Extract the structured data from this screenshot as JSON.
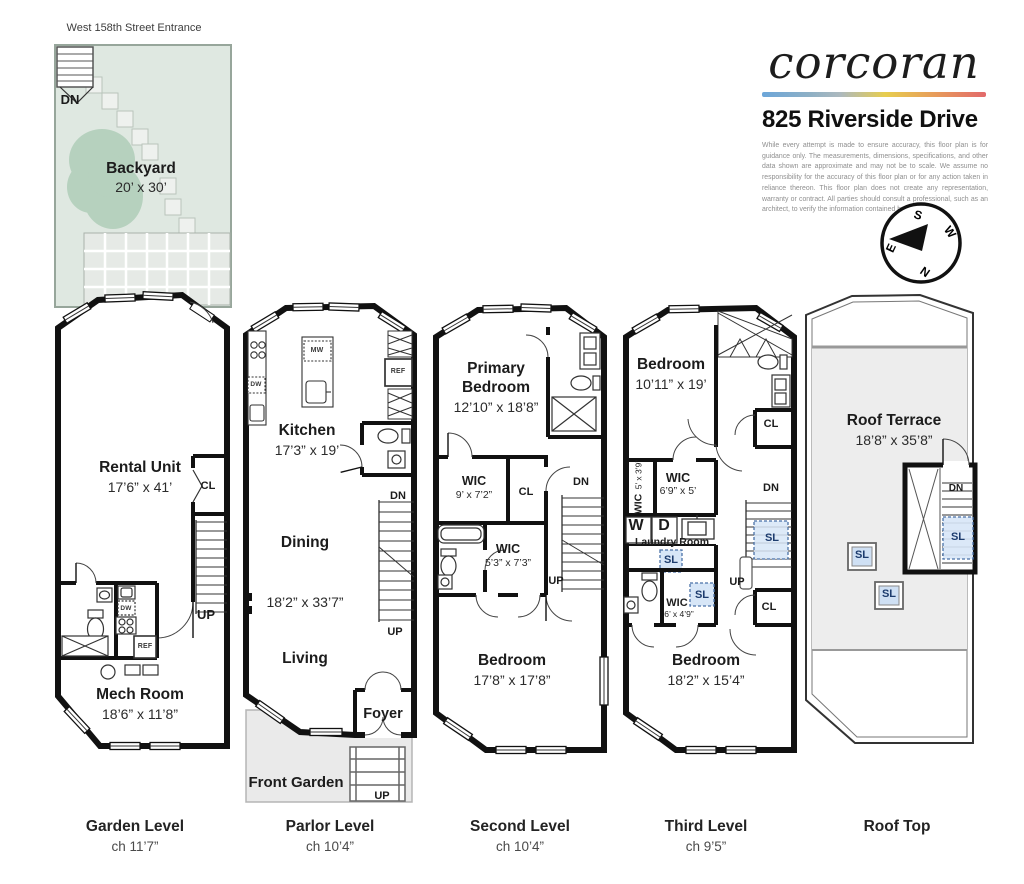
{
  "header": {
    "brand": "corcoran",
    "address": "825 Riverside Drive",
    "disclaimer": "While every attempt is made to ensure accuracy, this floor plan is for guidance only. The measurements, dimensions, specifications, and other data shown are approximate and may not be to scale. We assume no responsibility for the accuracy of this floor plan or for any action taken in reliance thereon. This floor plan does not create any representation, warranty or contract. All parties should consult a professional, such as an architect, to verify the information contained herein.",
    "bar_colors": {
      "blue": "#6CA6D9",
      "gray": "#ADB9BE",
      "yellow": "#E7CD4E",
      "orange": "#E79A5B",
      "red": "#E2696B"
    }
  },
  "compass": {
    "top": "S",
    "right": "W",
    "bottom": "N",
    "left": "E"
  },
  "entrance": "West 158th Street Entrance",
  "abbr": {
    "dn": "DN",
    "up": "UP",
    "cl": "CL",
    "sl": "SL",
    "dw": "DW",
    "ref": "REF",
    "mw": "MW",
    "w": "W",
    "d": "D"
  },
  "garden": {
    "backyard": {
      "name": "Backyard",
      "dims": "20’ x 30’"
    },
    "rental": {
      "name": "Rental Unit",
      "dims": "17’6” x 41’"
    },
    "mech": {
      "name": "Mech Room",
      "dims": "18’6” x 11’8”"
    },
    "caption": {
      "title": "Garden Level",
      "ch": "ch 11’7”"
    }
  },
  "parlor": {
    "kitchen": {
      "name": "Kitchen",
      "dims": "17’3” x 19’"
    },
    "dining": {
      "name": "Dining"
    },
    "dims": "18’2” x 33’7”",
    "living": {
      "name": "Living"
    },
    "foyer": {
      "name": "Foyer"
    },
    "front_garden": {
      "name": "Front Garden"
    },
    "caption": {
      "title": "Parlor Level",
      "ch": "ch 10’4”"
    }
  },
  "second": {
    "primary": {
      "name": "Primary Bedroom",
      "dims": "12’10” x 18’8”"
    },
    "wic1": {
      "name": "WIC",
      "dims": "9’ x 7’2”"
    },
    "wic2": {
      "name": "WIC",
      "dims": "5’3” x 7’3”"
    },
    "bedroom": {
      "name": "Bedroom",
      "dims": "17’8” x 17’8”"
    },
    "caption": {
      "title": "Second Level",
      "ch": "ch 10’4”"
    }
  },
  "third": {
    "bedroom1": {
      "name": "Bedroom",
      "dims": "10’11” x 19’"
    },
    "wic1": {
      "name": "WIC",
      "dims": "5’ x 3’9”"
    },
    "wic2": {
      "name": "WIC",
      "dims": "6’9” x 5’"
    },
    "laundry": {
      "name": "Laundry Room"
    },
    "wic3": {
      "name": "WIC",
      "dims": "6’ x 4’9”"
    },
    "bedroom2": {
      "name": "Bedroom",
      "dims": "18’2” x 15’4”"
    },
    "caption": {
      "title": "Third Level",
      "ch": "ch 9’5”"
    }
  },
  "roof": {
    "terrace": {
      "name": "Roof Terrace",
      "dims": "18’8” x 35’8”"
    },
    "caption": {
      "title": "Roof Top",
      "ch": ""
    }
  }
}
